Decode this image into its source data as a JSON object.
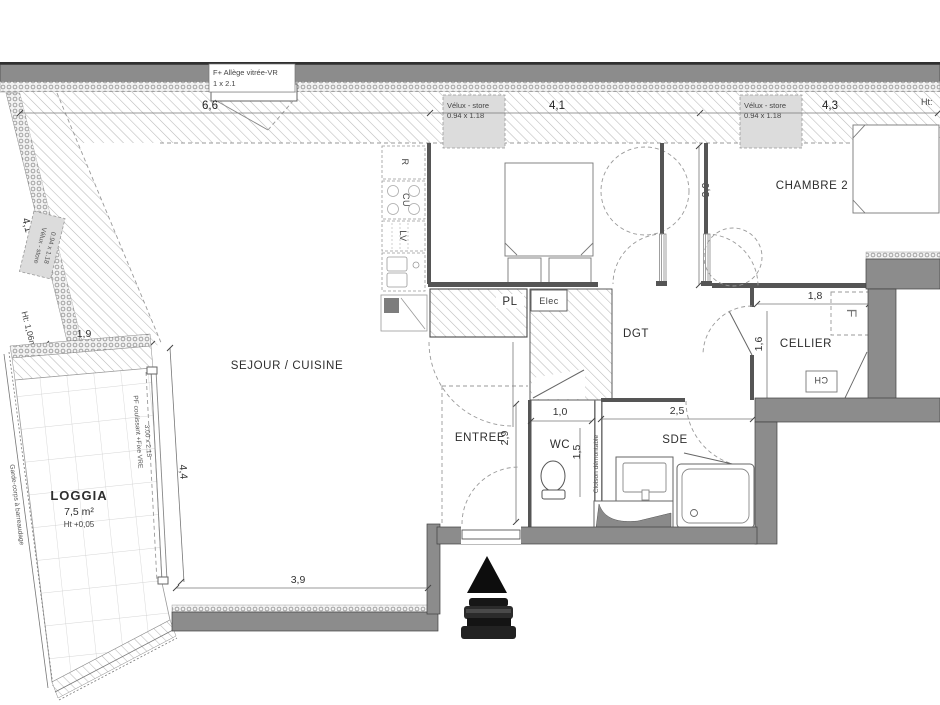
{
  "plan": {
    "rooms": {
      "sejour_cuisine": "SEJOUR / CUISINE",
      "chambre1": "CHAMBRE 1",
      "chambre2": "CHAMBRE 2",
      "entree": "ENTREE",
      "wc": "WC",
      "sde": "SDE",
      "dgt": "DGT",
      "cellier": "CELLIER",
      "pl": "PL",
      "elec": "Elec",
      "loggia": "LOGGIA",
      "loggia_area": "7,5 m²",
      "loggia_height": "Ht +0,05"
    },
    "appliances": {
      "fridge": "R",
      "cooktop": "CU",
      "dishwasher": "LV",
      "freezer": "F",
      "water_heater": "CH"
    },
    "openings": {
      "facade_window_label": "F+ Allège vitrée-VR",
      "facade_window_size": "1 x 2.1",
      "velux_label": "Vélux - store",
      "velux_size": "0.94 x 1.18",
      "bay_label": "PF coulissant +Fixe VRE",
      "bay_size": "3.00 x 2.15",
      "guardrail": "Garde-corps à barreaudage",
      "partition": "Cloison démontable",
      "height_left": "Ht: 1,06m",
      "height_right": "Ht:"
    },
    "dimensions": {
      "sejour_width": "6,6",
      "chambre1_width": "4,1",
      "chambre2_width": "4,3",
      "chambre_depth": "3,0",
      "roof_slope": "4,1",
      "loggia_top": "1,9",
      "loggia_side": "4,4",
      "sejour_bottom": "3,9",
      "entree_depth": "2,9",
      "wc_width": "1,0",
      "wc_depth": "1,5",
      "sde_width": "2,5",
      "cellier_width": "1,8",
      "cellier_depth": "1,6"
    },
    "colors": {
      "wall": "#8c8c8c",
      "line": "#3f3f3f",
      "hatch": "#b9b9b9"
    }
  }
}
